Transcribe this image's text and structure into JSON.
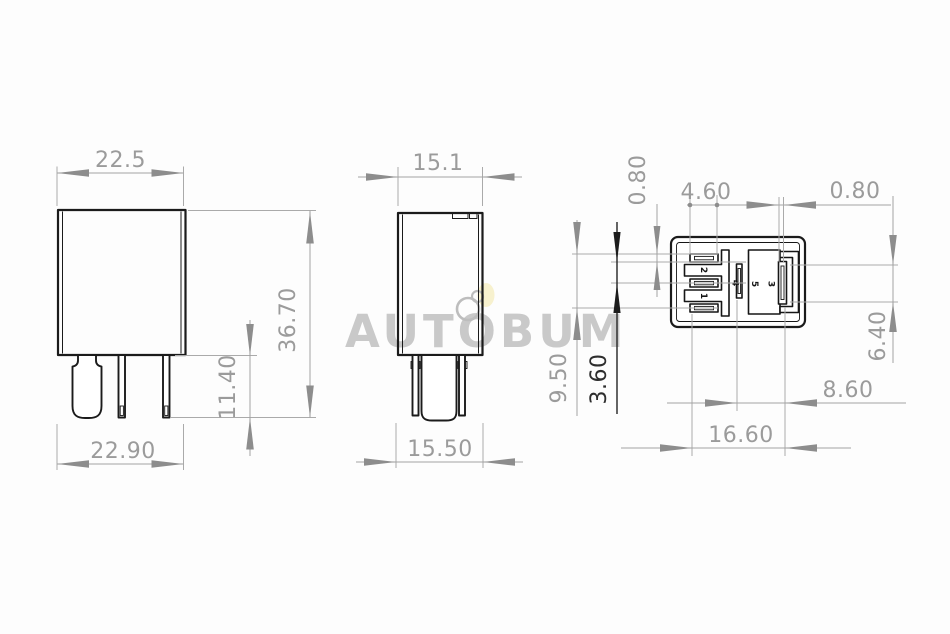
{
  "watermark": {
    "text": "AUTOBUM"
  },
  "front_view": {
    "width_top": "22.5",
    "height": "36.70",
    "pin_length": "11.40",
    "width_bottom": "22.90"
  },
  "side_view": {
    "depth_top": "15.1",
    "depth_bottom": "15.50"
  },
  "bottom_view": {
    "pin_labels": {
      "p1": "1",
      "p2": "2",
      "p3": "3",
      "p4": "4",
      "p5": "5"
    },
    "dims": {
      "slot_height": "0.80",
      "slot_length": "4.60",
      "blade_slot_width": "0.80",
      "pin_row_span": "9.50",
      "pin_row_pitch": "3.60",
      "blade_slot_length": "6.40",
      "blade_offset": "8.60",
      "total_width": "16.60"
    }
  }
}
